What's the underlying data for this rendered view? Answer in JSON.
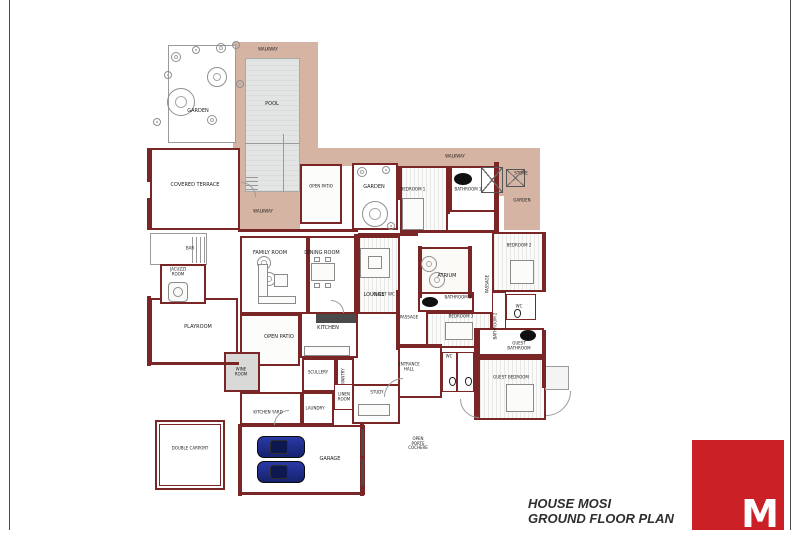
{
  "title_block": {
    "project": "HOUSE MOSI",
    "drawing": "GROUND FLOOR PLAN"
  },
  "logo": {
    "letter": "M",
    "color": "#cb2026"
  },
  "colors": {
    "wall": "#7a2626",
    "walkway": "#d6b4a4",
    "pool": "#e3e5e4",
    "car": "#1d2c88",
    "logo_red": "#cb2026"
  },
  "plan": {
    "areas": [
      {
        "name": "walkway-pool-top",
        "x": 233,
        "y": 42,
        "w": 85,
        "h": 20
      },
      {
        "name": "walkway-pool-left",
        "x": 233,
        "y": 60,
        "w": 12,
        "h": 132
      },
      {
        "name": "walkway-pool-right",
        "x": 300,
        "y": 60,
        "w": 18,
        "h": 90
      },
      {
        "name": "walkway-band-north",
        "x": 300,
        "y": 148,
        "w": 240,
        "h": 18
      },
      {
        "name": "pool-deck-south",
        "x": 240,
        "y": 192,
        "w": 60,
        "h": 40
      },
      {
        "name": "walkway-right-wrap",
        "x": 504,
        "y": 164,
        "w": 36,
        "h": 66
      },
      {
        "name": "skylight-zone",
        "x": 476,
        "y": 162,
        "w": 30,
        "h": 34
      }
    ],
    "pool": {
      "name": "pool",
      "x": 245,
      "y": 58,
      "w": 55,
      "h": 134
    },
    "rooms": [
      {
        "name": "garden-top-left",
        "x": 168,
        "y": 45,
        "w": 68,
        "h": 98,
        "b": "g1",
        "bg": "#ffffff"
      },
      {
        "name": "covered-terrace",
        "x": 150,
        "y": 148,
        "w": 90,
        "h": 82,
        "b": "w2",
        "bg": "#ffffff"
      },
      {
        "name": "open-patio-upper",
        "x": 300,
        "y": 164,
        "w": 42,
        "h": 60,
        "b": "w2",
        "bg": "#fcfcfb"
      },
      {
        "name": "garden-courtyard",
        "x": 352,
        "y": 163,
        "w": 46,
        "h": 67,
        "b": "w2",
        "bg": "#ffffff"
      },
      {
        "name": "bedroom-1",
        "x": 400,
        "y": 166,
        "w": 48,
        "h": 66,
        "b": "w2",
        "bg": "hatch"
      },
      {
        "name": "bathroom-1",
        "x": 450,
        "y": 166,
        "w": 46,
        "h": 46,
        "b": "w2",
        "bg": "#ffffff"
      },
      {
        "name": "bedroom-2",
        "x": 492,
        "y": 232,
        "w": 52,
        "h": 60,
        "b": "w2",
        "bg": "hatch"
      },
      {
        "name": "family-room",
        "x": 240,
        "y": 236,
        "w": 68,
        "h": 78,
        "b": "w2",
        "bg": "#ffffff"
      },
      {
        "name": "dining-room",
        "x": 308,
        "y": 236,
        "w": 50,
        "h": 78,
        "b": "w2",
        "bg": "#ffffff"
      },
      {
        "name": "lounge",
        "x": 358,
        "y": 236,
        "w": 42,
        "h": 78,
        "b": "w2",
        "bg": "hatch"
      },
      {
        "name": "atrium",
        "x": 420,
        "y": 247,
        "w": 52,
        "h": 50,
        "b": "w2",
        "bg": "#fbfaf7"
      },
      {
        "name": "bathroom-3",
        "x": 418,
        "y": 292,
        "w": 56,
        "h": 20,
        "b": "w2",
        "bg": "#ffffff"
      },
      {
        "name": "bedroom-3",
        "x": 426,
        "y": 312,
        "w": 66,
        "h": 36,
        "b": "w2",
        "bg": "hatch"
      },
      {
        "name": "passage-east",
        "x": 492,
        "y": 292,
        "w": 14,
        "h": 46,
        "b": "w1",
        "bg": "#ffffff"
      },
      {
        "name": "wc-east",
        "x": 506,
        "y": 294,
        "w": 30,
        "h": 26,
        "b": "w1",
        "bg": "#ffffff"
      },
      {
        "name": "kitchen",
        "x": 300,
        "y": 312,
        "w": 58,
        "h": 46,
        "b": "w2",
        "bg": "#ffffff"
      },
      {
        "name": "open-patio-lower",
        "x": 240,
        "y": 314,
        "w": 60,
        "h": 52,
        "b": "w2",
        "bg": "#fcfcfb"
      },
      {
        "name": "playroom",
        "x": 150,
        "y": 298,
        "w": 88,
        "h": 66,
        "b": "w2",
        "bg": "#ffffff"
      },
      {
        "name": "bar-nook",
        "x": 150,
        "y": 233,
        "w": 57,
        "h": 32,
        "b": "g1",
        "bg": "#ffffff"
      },
      {
        "name": "jacuzzi-room",
        "x": 160,
        "y": 264,
        "w": 46,
        "h": 40,
        "b": "w2",
        "bg": "#ffffff"
      },
      {
        "name": "wine-room",
        "x": 224,
        "y": 352,
        "w": 36,
        "h": 40,
        "b": "w2",
        "bg": "#d9d9d8"
      },
      {
        "name": "scullery",
        "x": 302,
        "y": 358,
        "w": 34,
        "h": 34,
        "b": "w2",
        "bg": "#ffffff"
      },
      {
        "name": "pantry",
        "x": 336,
        "y": 358,
        "w": 18,
        "h": 34,
        "b": "w2",
        "bg": "#ffffff"
      },
      {
        "name": "kitchen-yard",
        "x": 240,
        "y": 392,
        "w": 62,
        "h": 33,
        "b": "w2",
        "bg": "#ffffff"
      },
      {
        "name": "laundry",
        "x": 302,
        "y": 392,
        "w": 32,
        "h": 33,
        "b": "w2",
        "bg": "#ffffff"
      },
      {
        "name": "linen-room",
        "x": 334,
        "y": 384,
        "w": 22,
        "h": 26,
        "b": "w1",
        "bg": "#ffffff"
      },
      {
        "name": "garage",
        "x": 240,
        "y": 425,
        "w": 125,
        "h": 70,
        "b": "w2",
        "bg": "#ffffff"
      },
      {
        "name": "carport",
        "x": 155,
        "y": 420,
        "w": 70,
        "h": 70,
        "b": "carport",
        "bg": "#ffffff"
      },
      {
        "name": "study",
        "x": 352,
        "y": 384,
        "w": 48,
        "h": 40,
        "b": "w2",
        "bg": "#ffffff"
      },
      {
        "name": "entrance-hall",
        "x": 398,
        "y": 346,
        "w": 44,
        "h": 52,
        "b": "w2",
        "bg": "#ffffff"
      },
      {
        "name": "wc-stall-1",
        "x": 442,
        "y": 352,
        "w": 15,
        "h": 40,
        "b": "w1",
        "bg": "#ffffff"
      },
      {
        "name": "wc-stall-2",
        "x": 457,
        "y": 352,
        "w": 17,
        "h": 40,
        "b": "w1",
        "bg": "#ffffff"
      },
      {
        "name": "guest-bathroom",
        "x": 478,
        "y": 328,
        "w": 66,
        "h": 28,
        "b": "w2",
        "bg": "#ffffff"
      },
      {
        "name": "guest-bedroom",
        "x": 478,
        "y": 358,
        "w": 68,
        "h": 62,
        "b": "w2",
        "bg": "hatch"
      },
      {
        "name": "terrace-steps",
        "x": 545,
        "y": 366,
        "w": 24,
        "h": 24,
        "b": "g1",
        "bg": "#f4f4f3"
      }
    ],
    "walls": [
      {
        "x": 147,
        "y": 148,
        "w": 5,
        "h": 34
      },
      {
        "x": 147,
        "y": 198,
        "w": 5,
        "h": 32
      },
      {
        "x": 238,
        "y": 229,
        "w": 120,
        "h": 3
      },
      {
        "x": 358,
        "y": 233,
        "w": 60,
        "h": 3
      },
      {
        "x": 400,
        "y": 230,
        "w": 96,
        "h": 3
      },
      {
        "x": 396,
        "y": 166,
        "w": 4,
        "h": 34
      },
      {
        "x": 446,
        "y": 166,
        "w": 4,
        "h": 48
      },
      {
        "x": 494,
        "y": 162,
        "w": 5,
        "h": 72
      },
      {
        "x": 542,
        "y": 232,
        "w": 4,
        "h": 60
      },
      {
        "x": 418,
        "y": 246,
        "w": 4,
        "h": 52
      },
      {
        "x": 468,
        "y": 246,
        "w": 4,
        "h": 52
      },
      {
        "x": 354,
        "y": 234,
        "w": 4,
        "h": 82
      },
      {
        "x": 396,
        "y": 290,
        "w": 4,
        "h": 60
      },
      {
        "x": 474,
        "y": 328,
        "w": 4,
        "h": 92
      },
      {
        "x": 542,
        "y": 330,
        "w": 4,
        "h": 58
      },
      {
        "x": 238,
        "y": 424,
        "w": 4,
        "h": 72
      },
      {
        "x": 360,
        "y": 424,
        "w": 4,
        "h": 72
      },
      {
        "x": 238,
        "y": 492,
        "w": 126,
        "h": 3
      },
      {
        "x": 147,
        "y": 296,
        "w": 4,
        "h": 70
      },
      {
        "x": 398,
        "y": 344,
        "w": 44,
        "h": 3
      },
      {
        "x": 476,
        "y": 356,
        "w": 70,
        "h": 3
      },
      {
        "x": 147,
        "y": 362,
        "w": 92,
        "h": 3
      }
    ],
    "skylights": [
      {
        "name": "skylight-1",
        "x": 481,
        "y": 167,
        "w": 22,
        "h": 26
      },
      {
        "name": "skylight-2",
        "x": 506,
        "y": 169,
        "w": 19,
        "h": 18
      }
    ],
    "trees": [
      {
        "x": 181,
        "y": 102,
        "r": 14
      },
      {
        "x": 217,
        "y": 77,
        "r": 10
      },
      {
        "x": 176,
        "y": 57,
        "r": 5
      },
      {
        "x": 196,
        "y": 50,
        "r": 4
      },
      {
        "x": 221,
        "y": 48,
        "r": 5
      },
      {
        "x": 236,
        "y": 45,
        "r": 4
      },
      {
        "x": 212,
        "y": 120,
        "r": 5
      },
      {
        "x": 240,
        "y": 84,
        "r": 4
      },
      {
        "x": 157,
        "y": 122,
        "r": 4
      },
      {
        "x": 168,
        "y": 75,
        "r": 4
      },
      {
        "x": 375,
        "y": 214,
        "r": 13
      },
      {
        "x": 362,
        "y": 172,
        "r": 5
      },
      {
        "x": 386,
        "y": 170,
        "r": 4
      },
      {
        "x": 391,
        "y": 226,
        "r": 4
      },
      {
        "x": 429,
        "y": 264,
        "r": 8
      },
      {
        "x": 437,
        "y": 280,
        "r": 8
      },
      {
        "x": 264,
        "y": 263,
        "r": 7
      },
      {
        "x": 269,
        "y": 279,
        "r": 7
      }
    ],
    "fixtures": [
      {
        "type": "ellipse",
        "x": 454,
        "y": 173,
        "w": 18,
        "h": 12
      },
      {
        "type": "ellipse",
        "x": 422,
        "y": 297,
        "w": 16,
        "h": 10
      },
      {
        "type": "ellipse",
        "x": 520,
        "y": 330,
        "w": 16,
        "h": 11
      },
      {
        "type": "furn",
        "x": 168,
        "y": 282,
        "w": 20,
        "h": 20,
        "r": 4
      },
      {
        "type": "furn",
        "x": 173,
        "y": 287,
        "w": 10,
        "h": 10,
        "r": 10
      },
      {
        "type": "furn",
        "x": 402,
        "y": 198,
        "w": 22,
        "h": 32
      },
      {
        "type": "furn",
        "x": 510,
        "y": 260,
        "w": 24,
        "h": 24
      },
      {
        "type": "furn",
        "x": 445,
        "y": 322,
        "w": 28,
        "h": 18
      },
      {
        "type": "furn",
        "x": 506,
        "y": 384,
        "w": 28,
        "h": 28
      },
      {
        "type": "furn",
        "x": 311,
        "y": 263,
        "w": 24,
        "h": 18
      },
      {
        "type": "furn",
        "x": 314,
        "y": 257,
        "w": 6,
        "h": 5
      },
      {
        "type": "furn",
        "x": 325,
        "y": 257,
        "w": 6,
        "h": 5
      },
      {
        "type": "furn",
        "x": 314,
        "y": 283,
        "w": 6,
        "h": 5
      },
      {
        "type": "furn",
        "x": 325,
        "y": 283,
        "w": 6,
        "h": 5
      },
      {
        "type": "furn",
        "x": 258,
        "y": 264,
        "w": 10,
        "h": 36
      },
      {
        "type": "furn",
        "x": 258,
        "y": 296,
        "w": 38,
        "h": 8
      },
      {
        "type": "furn",
        "x": 274,
        "y": 274,
        "w": 14,
        "h": 13
      },
      {
        "type": "furn",
        "x": 360,
        "y": 248,
        "w": 30,
        "h": 30
      },
      {
        "type": "furn",
        "x": 368,
        "y": 256,
        "w": 14,
        "h": 13
      },
      {
        "type": "furn",
        "x": 358,
        "y": 404,
        "w": 32,
        "h": 12
      },
      {
        "type": "dark",
        "x": 316,
        "y": 314,
        "w": 40,
        "h": 9
      },
      {
        "type": "furn",
        "x": 304,
        "y": 346,
        "w": 46,
        "h": 10
      },
      {
        "type": "toilet",
        "x": 449,
        "y": 377,
        "w": 7,
        "h": 9
      },
      {
        "type": "toilet",
        "x": 465,
        "y": 377,
        "w": 7,
        "h": 9
      },
      {
        "type": "toilet",
        "x": 514,
        "y": 309,
        "w": 7,
        "h": 9
      },
      {
        "type": "dark",
        "x": 361,
        "y": 429,
        "w": 3,
        "h": 27
      },
      {
        "type": "dark",
        "x": 361,
        "y": 459,
        "w": 3,
        "h": 27
      },
      {
        "type": "vlines",
        "x": 192,
        "y": 237,
        "w": 14,
        "h": 26
      },
      {
        "type": "hlines",
        "x": 246,
        "y": 176,
        "w": 12,
        "h": 14
      },
      {
        "type": "line",
        "x": 283,
        "y": 134,
        "w": 1,
        "h": 58
      },
      {
        "type": "line",
        "x": 245,
        "y": 143,
        "w": 55,
        "h": 1
      }
    ],
    "cars": [
      {
        "name": "car-1",
        "x": 257,
        "y": 436,
        "w": 46,
        "h": 20
      },
      {
        "name": "car-2",
        "x": 257,
        "y": 461,
        "w": 46,
        "h": 20
      }
    ],
    "arcs": [
      {
        "x": 402,
        "y": 396,
        "r": 18,
        "rot": 0
      },
      {
        "x": 240,
        "y": 196,
        "r": 14,
        "rot": 90
      },
      {
        "x": 545,
        "y": 390,
        "r": 24,
        "rot": 180
      },
      {
        "x": 288,
        "y": 424,
        "r": 14,
        "rot": 0
      },
      {
        "x": 478,
        "y": 398,
        "r": 18,
        "rot": 270
      },
      {
        "x": 330,
        "y": 312,
        "r": 12,
        "rot": 90
      }
    ],
    "labels": [
      {
        "t": "WALKWAY",
        "x": 268,
        "y": 50,
        "s": 4
      },
      {
        "t": "POOL",
        "x": 272,
        "y": 105,
        "s": 5
      },
      {
        "t": "GARDEN",
        "x": 198,
        "y": 112,
        "s": 5
      },
      {
        "t": "COVERED TERRACE",
        "x": 195,
        "y": 186,
        "s": 5
      },
      {
        "t": "WALKWAY",
        "x": 263,
        "y": 212,
        "s": 4
      },
      {
        "t": "OPEN PATIO",
        "x": 321,
        "y": 187,
        "s": 4
      },
      {
        "t": "GARDEN",
        "x": 374,
        "y": 188,
        "s": 5
      },
      {
        "t": "WALKWAY",
        "x": 455,
        "y": 157,
        "s": 4
      },
      {
        "t": "BEDROOM 1",
        "x": 413,
        "y": 190,
        "s": 4
      },
      {
        "t": "BATHROOM 1",
        "x": 468,
        "y": 190,
        "s": 4
      },
      {
        "t": "STORE",
        "x": 521,
        "y": 174,
        "s": 4
      },
      {
        "t": "GARDEN",
        "x": 522,
        "y": 201,
        "s": 4
      },
      {
        "t": "BEDROOM 2",
        "x": 519,
        "y": 246,
        "s": 4
      },
      {
        "t": "PASSAGE",
        "x": 488,
        "y": 284,
        "s": 4,
        "rot": -90
      },
      {
        "t": "WC",
        "x": 519,
        "y": 307,
        "s": 4
      },
      {
        "t": "BATHROOM 2",
        "x": 496,
        "y": 326,
        "s": 4,
        "rot": -90
      },
      {
        "t": "FAMILY ROOM",
        "x": 270,
        "y": 254,
        "s": 5
      },
      {
        "t": "DINING ROOM",
        "x": 322,
        "y": 254,
        "s": 5
      },
      {
        "t": "LOUNGE",
        "x": 374,
        "y": 296,
        "s": 5
      },
      {
        "t": "ATRIUM",
        "x": 447,
        "y": 277,
        "s": 5
      },
      {
        "t": "BATHROOM 3",
        "x": 458,
        "y": 298,
        "s": 4
      },
      {
        "t": "BEDROOM 3",
        "x": 461,
        "y": 317,
        "s": 4
      },
      {
        "t": "GUEST WC",
        "x": 384,
        "y": 295,
        "s": 4
      },
      {
        "t": "PASSAGE",
        "x": 409,
        "y": 318,
        "s": 4
      },
      {
        "t": "KITCHEN",
        "x": 328,
        "y": 329,
        "s": 5
      },
      {
        "t": "OPEN PATIO",
        "x": 279,
        "y": 338,
        "s": 5
      },
      {
        "t": "PLAYROOM",
        "x": 198,
        "y": 328,
        "s": 5
      },
      {
        "t": "BAR",
        "x": 190,
        "y": 249,
        "s": 4
      },
      {
        "t": "JACUZZI ROOM",
        "x": 178,
        "y": 272,
        "s": 4,
        "w": 20
      },
      {
        "t": "WINE ROOM",
        "x": 241,
        "y": 372,
        "s": 4,
        "w": 18
      },
      {
        "t": "SCULLERY",
        "x": 318,
        "y": 373,
        "s": 4
      },
      {
        "t": "PANTRY",
        "x": 344,
        "y": 376,
        "s": 4,
        "rot": -90
      },
      {
        "t": "KITCHEN YARD",
        "x": 268,
        "y": 413,
        "s": 4
      },
      {
        "t": "LAUNDRY",
        "x": 315,
        "y": 409,
        "s": 4
      },
      {
        "t": "LINEN ROOM",
        "x": 344,
        "y": 397,
        "s": 4,
        "w": 16
      },
      {
        "t": "GARAGE",
        "x": 330,
        "y": 460,
        "s": 5
      },
      {
        "t": "DOUBLE CARPORT",
        "x": 190,
        "y": 449,
        "s": 4
      },
      {
        "t": "STUDY",
        "x": 377,
        "y": 393,
        "s": 4
      },
      {
        "t": "ENTRANCE HALL",
        "x": 409,
        "y": 367,
        "s": 4,
        "w": 26
      },
      {
        "t": "WC",
        "x": 449,
        "y": 357,
        "s": 4
      },
      {
        "t": "GUEST BATHROOM",
        "x": 519,
        "y": 346,
        "s": 4,
        "w": 28
      },
      {
        "t": "GUEST BEDROOM",
        "x": 511,
        "y": 378,
        "s": 4
      },
      {
        "t": "OPEN PORTE COCHERE",
        "x": 418,
        "y": 444,
        "s": 4,
        "w": 24
      }
    ]
  }
}
